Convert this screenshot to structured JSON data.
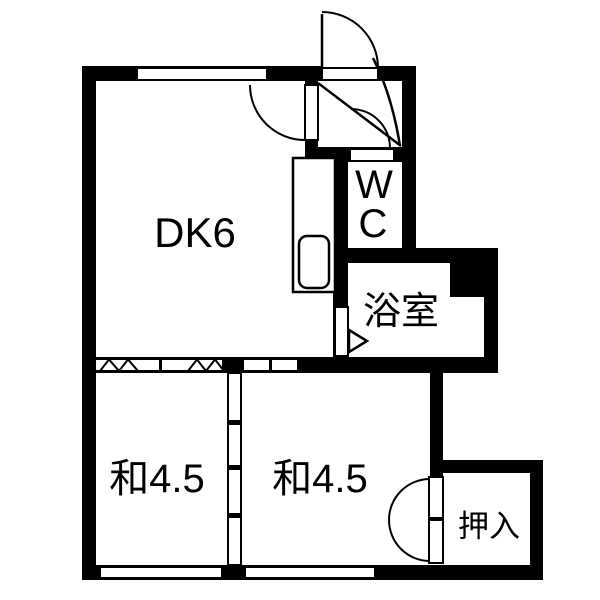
{
  "plan": {
    "type": "floor-plan",
    "background": "#ffffff",
    "wall_color": "#000000",
    "line_color": "#000000",
    "rooms": {
      "dk": {
        "label": "DK6"
      },
      "wc": {
        "label": "WC",
        "lines": [
          "W",
          "C"
        ]
      },
      "bath": {
        "label": "浴室"
      },
      "washitsu_left": {
        "label": "和4.5"
      },
      "washitsu_right": {
        "label": "和4.5"
      },
      "oshiire": {
        "label": "押入"
      }
    },
    "features": [
      "entry-door-top-right-swing-out",
      "genkan-cross-lines",
      "wc-door-swing-arc",
      "kitchen-counter-with-sink",
      "bath-folding-door-triangle",
      "accordion-partition-dk-to-washitsu",
      "two-panel-sliding-door-dk-to-washitsu",
      "fusuma-divider-between-washitsu",
      "oshiire-double-doors",
      "windows-top-and-bottom-walls"
    ]
  }
}
